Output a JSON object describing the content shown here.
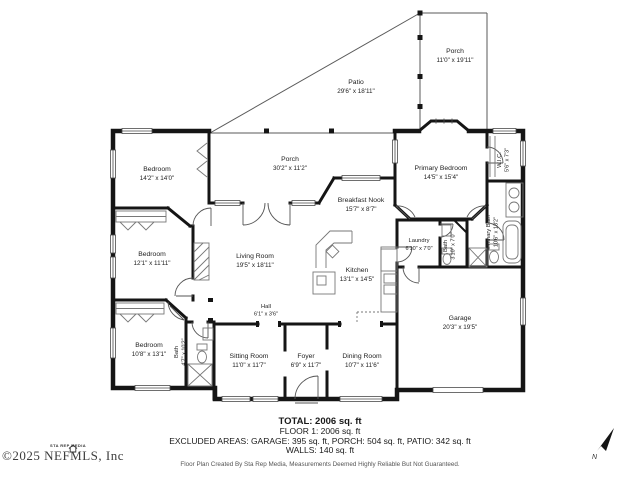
{
  "rooms": {
    "patio": {
      "name": "Patio",
      "dims": "29'6\" x 18'11\""
    },
    "porch_rear": {
      "name": "Porch",
      "dims": "11'0\" x 19'11\""
    },
    "porch_main": {
      "name": "Porch",
      "dims": "30'2\" x 11'2\""
    },
    "bedroom2": {
      "name": "Bedroom",
      "dims": "14'2\" x 14'0\""
    },
    "primary_bedroom": {
      "name": "Primary Bedroom",
      "dims": "14'5\" x 15'4\""
    },
    "wic": {
      "name": "W.I.C.",
      "dims": "5'6\" x 7'3\""
    },
    "primary_bath": {
      "name": "Primary Bath",
      "dims": "10'6\" x 13'2\""
    },
    "breakfast_nook": {
      "name": "Breakfast Nook",
      "dims": "15'7\" x 8'7\""
    },
    "bedroom3": {
      "name": "Bedroom",
      "dims": "12'1\" x 11'11\""
    },
    "living_room": {
      "name": "Living Room",
      "dims": "19'5\" x 18'11\""
    },
    "kitchen": {
      "name": "Kitchen",
      "dims": "13'1\" x 14'5\""
    },
    "laundry": {
      "name": "Laundry",
      "dims": "6'10\" x 7'0\""
    },
    "bath2": {
      "name": "Bath",
      "dims": "3'10\" x 7'0\""
    },
    "hall": {
      "name": "Hall",
      "dims": "6'1\" x 3'6\""
    },
    "bedroom4": {
      "name": "Bedroom",
      "dims": "10'8\" x 13'1\""
    },
    "bath1": {
      "name": "Bath",
      "dims": "4'7\" x 10'2\""
    },
    "sitting_room": {
      "name": "Sitting Room",
      "dims": "11'0\" x 11'7\""
    },
    "foyer": {
      "name": "Foyer",
      "dims": "6'9\" x 11'7\""
    },
    "dining_room": {
      "name": "Dining Room",
      "dims": "10'7\" x 11'6\""
    },
    "garage": {
      "name": "Garage",
      "dims": "20'3\" x 19'5\""
    }
  },
  "summary": {
    "total": "TOTAL: 2006 sq. ft",
    "floor1": "FLOOR 1: 2006 sq. ft",
    "excluded": "EXCLUDED AREAS: GARAGE: 395 sq. ft, PORCH: 504 sq. ft, PATIO: 342 sq. ft",
    "walls": "WALLS: 140 sq. ft",
    "disclaimer": "Floor Plan Created By Sta Rep Media, Measurements Deemed Highly Reliable But Not Guaranteed."
  },
  "watermark": {
    "logo": "STA REP MEDIA",
    "text": "©2025 NEFMLS, Inc"
  },
  "compass": {
    "north": "N"
  },
  "colors": {
    "wall": "#151515",
    "thin_line": "#5a5a5a",
    "text": "#222222",
    "background": "#ffffff"
  }
}
